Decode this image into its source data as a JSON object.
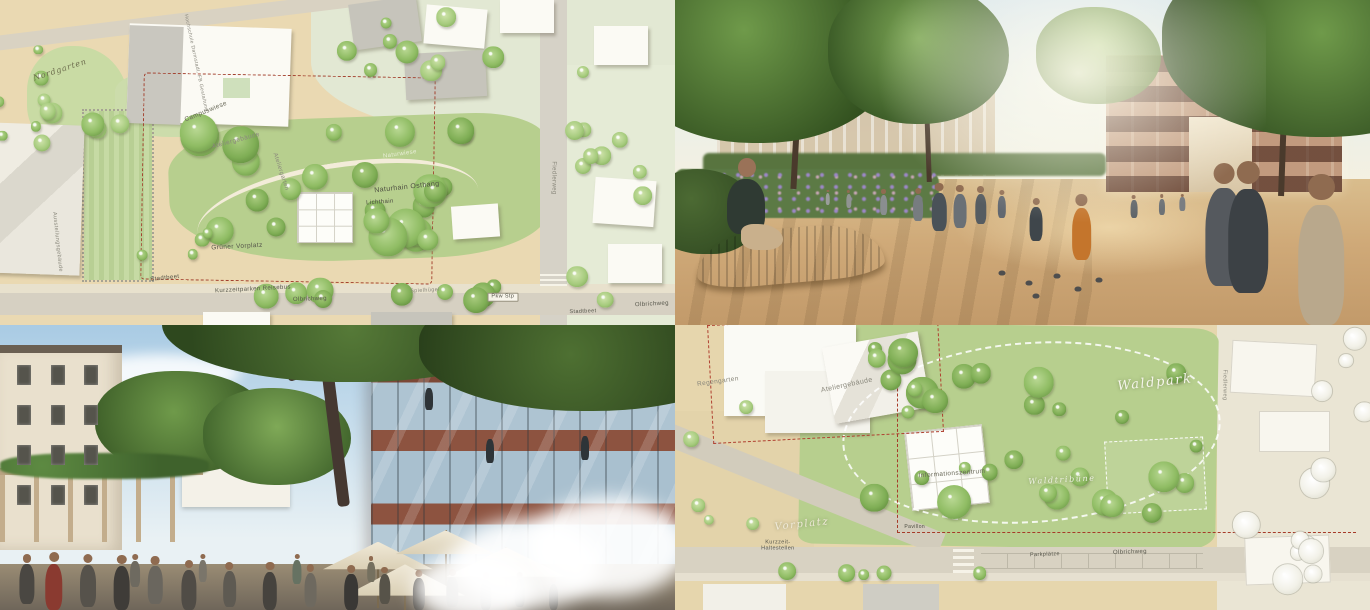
{
  "meta": {
    "width": 1370,
    "height": 610,
    "layout": "2x2 collage of landscape-architecture competition images"
  },
  "palette": {
    "plan_paper": "#ead9b2",
    "plan_green": "#b7cf8e",
    "plan_road": "#d6d0c2",
    "boundary_red": "#a3402e",
    "render_sky": "#dfe9ee",
    "render_ground": "#cfae80",
    "brick": "#8f5440",
    "canopy_green": "#3c5c28"
  },
  "panels": [
    {
      "id": "plan_nordgarten",
      "kind": "site-plan",
      "description": "Coloured landscape site plan with lawns, tree groves, paths, roads and buildings around a sloped park",
      "labels": [
        {
          "text": "Nordgarten",
          "x": 8.9,
          "y": 21.5,
          "rot": -18,
          "cls": "script",
          "size": 8,
          "color": "#6e6e4e",
          "name": "label-nordgarten"
        },
        {
          "text": "Hochschule Darmstadt, FB Gestaltung",
          "x": 29,
          "y": 19.5,
          "rot": 78,
          "cls": "tiny",
          "size": 5,
          "color": "#8a887e",
          "name": "label-hochschule-darmstadt"
        },
        {
          "text": "Campuswiese",
          "x": 30.5,
          "y": 34.5,
          "rot": -22,
          "size": 6.5,
          "color": "#6a6a5a",
          "name": "label-campuswiese"
        },
        {
          "text": "Ateliergebäude",
          "x": 35,
          "y": 43.5,
          "rot": -15,
          "size": 6.5,
          "color": "#8a887c",
          "name": "label-ateliergebaeude"
        },
        {
          "text": "Ateliergarten",
          "x": 41.5,
          "y": 53,
          "rot": 72,
          "size": 6,
          "color": "#8a887c",
          "name": "label-ateliergarten"
        },
        {
          "text": "Naturwiese",
          "x": 59.3,
          "y": 47.7,
          "rot": -8,
          "size": 6,
          "color": "#e9eed8",
          "name": "label-naturwiese"
        },
        {
          "text": "Naturhain Osthang",
          "x": 60.3,
          "y": 57.8,
          "rot": -6,
          "size": 7,
          "color": "#4c4c40",
          "name": "label-naturhain-osthang"
        },
        {
          "text": "Lichthain",
          "x": 56.3,
          "y": 62.5,
          "rot": -4,
          "size": 6,
          "color": "#4c4c40",
          "name": "label-lichthain"
        },
        {
          "text": "Grüner Vorplatz",
          "x": 35.1,
          "y": 76,
          "rot": -3,
          "size": 6.5,
          "color": "#55554a",
          "name": "label-gruener-vorplatz"
        },
        {
          "text": "Stadtbeet",
          "x": 24.4,
          "y": 85.8,
          "rot": -6,
          "size": 6,
          "color": "#55554a",
          "name": "label-stadtbeet"
        },
        {
          "text": "Kurzzeitparken Reisebus",
          "x": 37.5,
          "y": 89.2,
          "rot": -3,
          "size": 6,
          "color": "#55554a",
          "name": "label-kurzzeitparken"
        },
        {
          "text": "Olbrichweg",
          "x": 45.9,
          "y": 92.3,
          "rot": -2,
          "size": 6,
          "color": "#55554a",
          "name": "label-olbrichweg"
        },
        {
          "text": "Spielhügel",
          "x": 63,
          "y": 89.5,
          "rot": -3,
          "size": 5.5,
          "color": "#8a887c",
          "name": "label-spielhuegel"
        },
        {
          "text": "Pkw Stp",
          "x": 74.5,
          "y": 91.4,
          "rot": 0,
          "cls": "boxed",
          "size": 5.5,
          "color": "#55554a",
          "name": "label-pkw-stp"
        },
        {
          "text": "Fiedlerweg",
          "x": 81.9,
          "y": 54.8,
          "rot": 90,
          "size": 6,
          "color": "#8a887c",
          "name": "label-fiedlerweg"
        },
        {
          "text": "Ausstellungsgebäude",
          "x": 8.4,
          "y": 74.5,
          "rot": 84,
          "size": 5.5,
          "color": "#8a887c",
          "name": "label-ausstellungsgebaeude"
        },
        {
          "text": "Olbrichweg",
          "x": 96.6,
          "y": 93.8,
          "rot": -3,
          "size": 6,
          "color": "#55554a",
          "name": "label-olbrichweg-east"
        },
        {
          "text": "Stadtbeet",
          "x": 86.4,
          "y": 96,
          "rot": -2,
          "size": 5.5,
          "color": "#55554a",
          "name": "label-stadtbeet-east"
        }
      ]
    },
    {
      "id": "render_plaza",
      "kind": "rendering",
      "description": "Eye-level visualisation of a sunny tree-lined gravel plaza with pedestrians, children, pigeons and a curved wooden bench in front of a brick campus building",
      "labels": []
    },
    {
      "id": "render_atrium",
      "kind": "rendering",
      "description": "Eye-level visualisation of a brick building with full-height glazing beside a large tree, with pergola, café umbrellas, visitors and a misting water feature",
      "labels": []
    },
    {
      "id": "plan_waldpark",
      "kind": "site-plan",
      "description": "Coloured landscape site plan of a forest park with atelier building, information centre, forecourt and parking along a street",
      "labels": [
        {
          "text": "Regengarten",
          "x": 6.2,
          "y": 20,
          "rot": -8,
          "size": 6.5,
          "color": "#8a887c",
          "name": "label-regengarten"
        },
        {
          "text": "Ateliergebäude",
          "x": 24.8,
          "y": 21.5,
          "rot": -12,
          "size": 7,
          "color": "#8a887c",
          "name": "label-ateliergebaeude"
        },
        {
          "text": "Waldpark",
          "x": 69,
          "y": 20.4,
          "rot": -6,
          "cls": "script-white",
          "size": 13,
          "color": "#f5f5ea",
          "name": "label-waldpark"
        },
        {
          "text": "Informationszentrum",
          "x": 39.9,
          "y": 52.3,
          "rot": -4,
          "size": 6.5,
          "color": "#6a6a5a",
          "name": "label-informationszentrum"
        },
        {
          "text": "Waldtribüne",
          "x": 55.7,
          "y": 54.4,
          "rot": -3,
          "cls": "script-white",
          "size": 8,
          "color": "#eef2e2",
          "name": "label-waldtribuene"
        },
        {
          "text": "Vorplatz",
          "x": 18.3,
          "y": 70.2,
          "rot": -6,
          "cls": "script-white",
          "size": 10,
          "color": "#efe9d8",
          "name": "label-vorplatz"
        },
        {
          "text": "Kurzzeit-\nHaltestellen",
          "x": 14.8,
          "y": 77.5,
          "rot": 0,
          "size": 5.5,
          "color": "#55554a",
          "name": "label-kurzzeit-haltestellen"
        },
        {
          "text": "Pavillon",
          "x": 34.5,
          "y": 70.9,
          "rot": 0,
          "size": 5,
          "color": "#4c4c40",
          "name": "label-pavillon"
        },
        {
          "text": "Parkplätze",
          "x": 53.2,
          "y": 80.7,
          "rot": -2,
          "size": 5.5,
          "color": "#55554a",
          "name": "label-parkplaetze"
        },
        {
          "text": "Olbrichweg",
          "x": 65.5,
          "y": 80,
          "rot": -2,
          "size": 6,
          "color": "#55554a",
          "name": "label-olbrichweg"
        },
        {
          "text": "Fiedlerweg",
          "x": 79,
          "y": 21,
          "rot": 90,
          "size": 5.5,
          "color": "#8a887c",
          "name": "label-fiedlerweg"
        }
      ]
    }
  ]
}
